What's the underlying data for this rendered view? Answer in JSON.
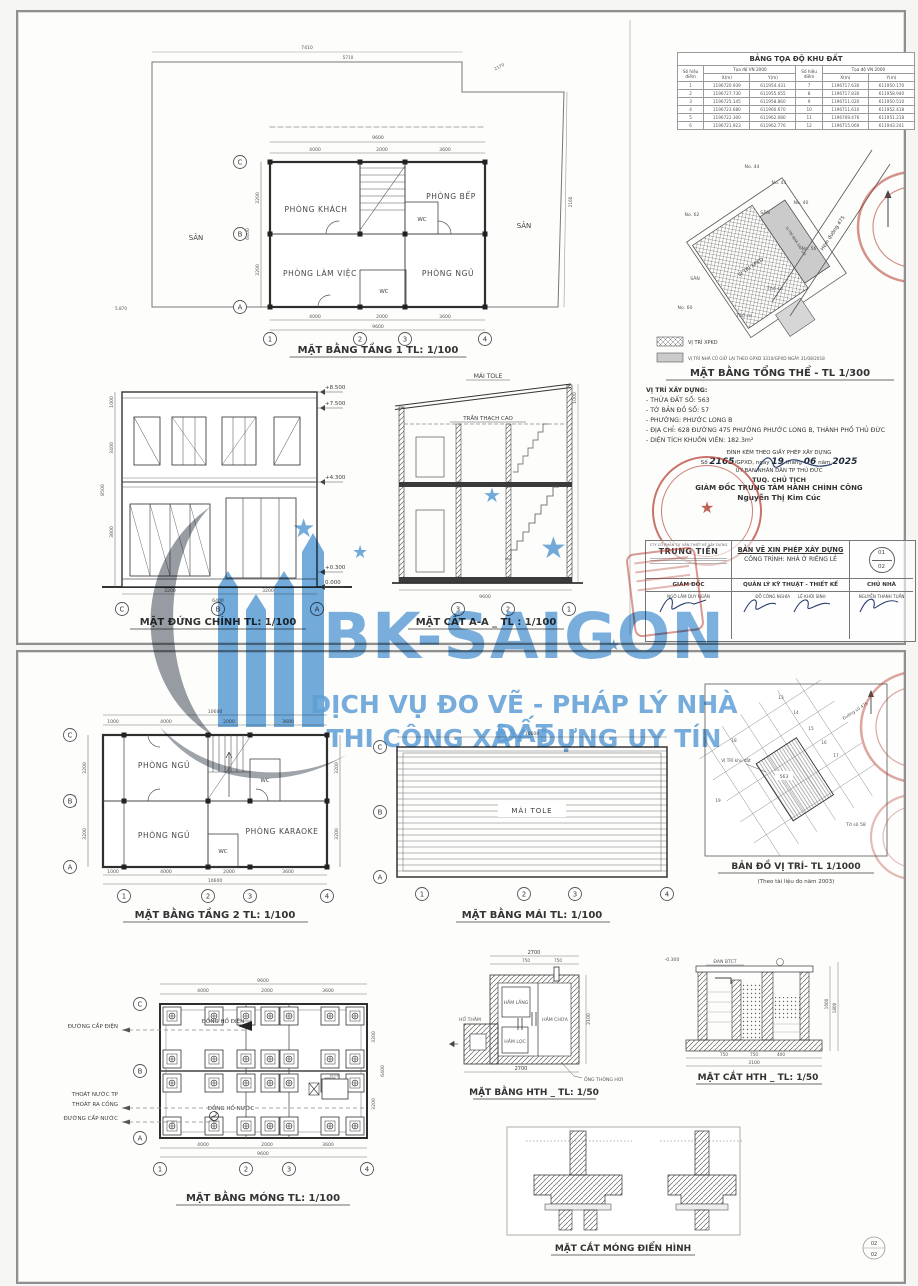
{
  "watermark": {
    "brand": "BK-SAIGON",
    "tagline1": "DỊCH VỤ ĐO VẼ - PHÁP LÝ NHÀ ĐẤT",
    "tagline2": "THI CÔNG XÂY DỰNG UY TÍN",
    "blue": "#5b9fd8",
    "gray": "#97a0a8"
  },
  "sheet1": {
    "coord_table": {
      "title": "BẢNG TỌA ĐỘ KHU ĐẤT",
      "col_point": "Số hiệu điểm",
      "col_group": "Tọa độ VN 2000",
      "col_x": "X(m)",
      "col_y": "Y(m)",
      "rows": [
        {
          "n1": "1",
          "x1": "1196720.939",
          "y1": "611954.431",
          "n2": "7",
          "x2": "1196717.630",
          "y2": "611950.170"
        },
        {
          "n1": "2",
          "x1": "1196727.730",
          "y1": "611955.655",
          "n2": "8",
          "x2": "1196717.830",
          "y2": "611958.940"
        },
        {
          "n1": "3",
          "x1": "1196725.145",
          "y1": "611958.860",
          "n2": "9",
          "x2": "1196711.020",
          "y2": "611950.510"
        },
        {
          "n1": "4",
          "x1": "1196723.680",
          "y1": "611960.670",
          "n2": "10",
          "x2": "1196711.610",
          "y2": "611952.418"
        },
        {
          "n1": "5",
          "x1": "1196722.300",
          "y1": "611962.080",
          "n2": "11",
          "x2": "1196709.476",
          "y2": "611951.218"
        },
        {
          "n1": "6",
          "x1": "1196721.923",
          "y1": "611962.776",
          "n2": "12",
          "x2": "1196715.069",
          "y2": "611943.241"
        }
      ]
    },
    "plan1": {
      "title": "MẶT BẰNG TẦNG 1 TL: 1/100",
      "living": "PHÒNG KHÁCH",
      "kitchen": "PHÒNG BẾP",
      "wc1": "WC",
      "office": "PHÒNG LÀM VIỆC",
      "bed": "PHÒNG NGỦ",
      "wc2": "WC",
      "yard_l": "SÂN",
      "yard_r": "SÂN",
      "dim_top": [
        "4000",
        "2000",
        "3600"
      ],
      "dim_total": "9600",
      "dim_left": [
        "3200",
        "3200"
      ],
      "dim_left_total": "6400",
      "site_top": "7410",
      "site_top2": "5710",
      "site_corner": "2170",
      "site_left": "5.870",
      "site_right": "2160",
      "grid_cols": [
        "1",
        "2",
        "3",
        "4"
      ],
      "grid_rows": [
        "C",
        "B",
        "A"
      ]
    },
    "elevation": {
      "title": "MẶT ĐỨNG CHÍNH  TL: 1/100",
      "levels": [
        "+8.500",
        "+7.500",
        "+4.300",
        "+0.300",
        "0.000"
      ],
      "dim_left": [
        "1000",
        "3400",
        "3800"
      ],
      "dim_left_total": "8500",
      "dim_bottom": [
        "3200",
        "3200"
      ],
      "dim_bottom_total": "6400",
      "grid": [
        "C",
        "B",
        "A"
      ]
    },
    "section": {
      "title": "MẶT CẮT A-A _ TL : 1/100",
      "roof": "MÁI TOLE",
      "ceiling": "TRẦN THẠCH CAO",
      "dim_roof": "1000",
      "dim_total": "9600",
      "grid": [
        "3",
        "2",
        "1"
      ]
    },
    "site_plan": {
      "title": "MẶT BẰNG TỔNG THỂ - TL 1/300",
      "legend1": "VỊ TRÍ XPKD",
      "legend2": "VỊ TRÍ NHÀ CŨ GIỮ LẠI THEO GPXD 3310/GPXD NGÀY 31/08/2018",
      "lot44": "No. 44",
      "lot45": "No. 45",
      "lot40": "No. 40",
      "lot62": "No. 62",
      "lot56": "No. 56",
      "lot60": "No. 60",
      "yard1": "SÂN",
      "yard2": "SÂN",
      "thocu1": "Thổ cư",
      "thocu2": "Thổ cư",
      "xpkd": "VỊ TRÍ XPKD",
      "giulai": "VỊ TRÍ NHÀ GIỮ LẠI",
      "road": "Hẻm đường 475"
    },
    "location_info": {
      "heading": "VỊ TRÍ XÂY DỰNG:",
      "items": [
        "- THỬA ĐẤT SỐ:  563",
        "- TỜ BẢN ĐỒ SỐ:  57",
        "- PHƯỜNG:  PHƯỚC LONG B",
        "- ĐỊA CHỈ:  628 ĐƯỜNG 475 PHƯỜNG PHƯỚC LONG B, THÀNH PHỐ THỦ ĐỨC",
        "- DIỆN TÍCH KHUÔN VIÊN:  182.3m²"
      ]
    },
    "approval": {
      "line1": "ĐÍNH KÈM THEO GIẤY PHÉP XÂY DỰNG",
      "l2a": "Số",
      "l2b": "2165",
      "l2c": "/GPXD, ngày",
      "l2d": "19",
      "l2e": "tháng",
      "l2f": "06",
      "l2g": "năm",
      "l2h": "2025",
      "line3": "ỦY BAN NHÂN DÂN TP THỦ ĐỨC",
      "line4": "TUQ. CHỦ TỊCH",
      "line5": "GIÁM ĐỐC TRUNG TÂM HÀNH CHÍNH CÔNG",
      "signer": "Nguyễn Thị Kim Cúc"
    },
    "title_block": {
      "company_small": "CTY CỔ PHẦN TƯ VẤN THIẾT KẾ XÂY DỰNG",
      "company": "TRUNG TIẾN",
      "doc_title": "BẢN VẼ XIN PHÉP XÂY DỰNG",
      "doc_subtitle": "CÔNG TRÌNH: NHÀ Ở RIÊNG LẺ",
      "sheet_no": "01",
      "sheet_total": "02",
      "role1": "GIÁM ĐỐC",
      "role2": "QUẢN LÝ KỸ THUẬT - THIẾT KẾ",
      "role3": "CHỦ NHÀ",
      "name1": "NGÔ LÂM DUY NGÂN",
      "name2a": "ĐỖ CÔNG NGHĨA",
      "name2b": "LÊ KHÔI SINH",
      "name3": "NGUYỄN THANH TUẤN"
    }
  },
  "sheet2": {
    "plan2": {
      "title": "MẶT BẰNG TẦNG 2 TL: 1/100",
      "bed1": "PHÒNG NGỦ",
      "bed2": "PHÒNG NGỦ",
      "karaoke": "PHÒNG KARAOKE",
      "wc1": "WC",
      "wc2": "WC",
      "dim_bottom": [
        "1000",
        "4000",
        "2000",
        "3600"
      ],
      "dim_total": "10600",
      "dim_left": [
        "3200",
        "3200"
      ],
      "dim_left_total": "6400",
      "grid_cols": [
        "1",
        "2",
        "3",
        "4"
      ],
      "grid_rows": [
        "C",
        "B",
        "A"
      ]
    },
    "roof": {
      "title": "MẶT BẰNG MÁI TL: 1/100",
      "label": "MÁI TOLE",
      "dim_total": "10600",
      "grid_cols": [
        "1",
        "2",
        "3",
        "4"
      ],
      "grid_rows": [
        "C",
        "B",
        "A"
      ]
    },
    "map": {
      "title": "BẢN ĐỒ VỊ TRÍ- TL 1/1000",
      "subtitle": "(Theo tài liệu đo năm 2003)",
      "parcel": "563",
      "label": "VỊ TRÍ khu đất",
      "sheet_label": "Tờ số 58",
      "road": "Đường số 475",
      "lots": [
        "13",
        "14",
        "15",
        "16",
        "17",
        "18",
        "19"
      ]
    },
    "foundation": {
      "title": "MẶT BẰNG MÓNG TL: 1/100",
      "ann_power": "ĐƯỜNG CẤP ĐIỆN",
      "ann_drain1": "THOÁT NƯỚC TP",
      "ann_drain2": "THOÁT RA CỐNG",
      "ann_water": "ĐƯỜNG CẤP NƯỚC",
      "meter_e": "ĐỒNG HỒ ĐIỆN",
      "meter_w": "ĐỒNG HỒ NƯỚC",
      "hth": "HTH",
      "dim_top": [
        "4000",
        "2000",
        "3600"
      ],
      "dim_total": "9600",
      "dim_right": [
        "3200",
        "3200"
      ],
      "dim_right_total": "6400",
      "grid_cols": [
        "1",
        "2",
        "3",
        "4"
      ],
      "grid_rows": [
        "C",
        "B",
        "A"
      ]
    },
    "hth_plan": {
      "title": "MẶT BẰNG HTH _ TL: 1/50",
      "lang": "HẦM LẮNG",
      "chua": "HẦM CHỨA",
      "loc": "HẦM LỌC",
      "tham": "HỐ THĂM",
      "vent": "ỐNG THÔNG HƠI",
      "dim_top": "2700",
      "seg1": "750",
      "seg2": "750",
      "dim_bottom": "2700",
      "dim_right": "2100"
    },
    "hth_section": {
      "title": "MẶT CẮT HTH _ TL: 1/50",
      "dan": "ĐAN BTCT",
      "level": "-0.300",
      "d1": "750",
      "d2": "750",
      "d3": "400",
      "total": "3100",
      "r1": "1600",
      "r2": "1800"
    },
    "footing": {
      "title": "MẶT CẮT MÓNG ĐIỂN HÌNH"
    },
    "badge_top": "02",
    "badge_bottom": "02"
  }
}
